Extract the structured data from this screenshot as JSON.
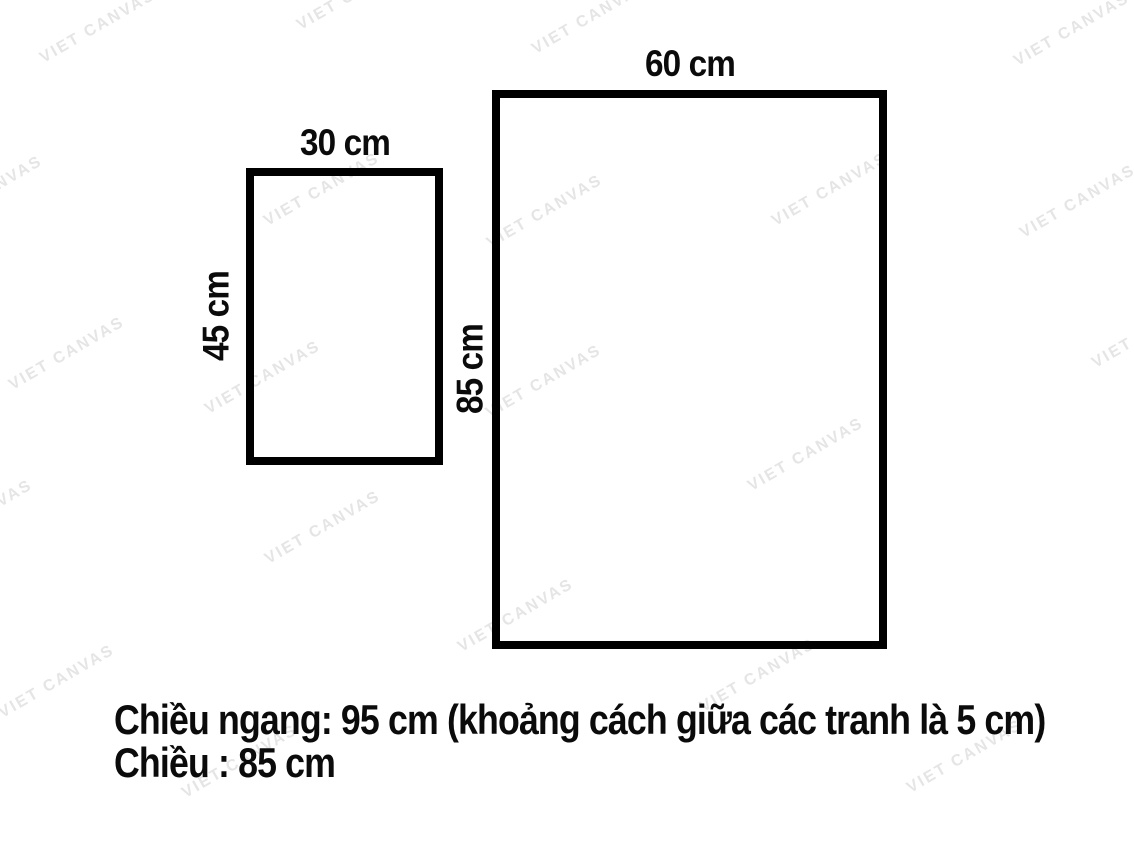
{
  "watermark": {
    "text": "VIET CANVAS",
    "color": "#e5e5e5",
    "angle_deg": -30
  },
  "diagram": {
    "stroke_color": "#000000",
    "stroke_px": 8,
    "frames": [
      {
        "name": "small-frame",
        "width_label": "30 cm",
        "height_label": "45 cm"
      },
      {
        "name": "large-frame",
        "width_label": "60 cm",
        "height_label": "85 cm"
      }
    ]
  },
  "caption": {
    "line1": "Chiều ngang: 95 cm (khoảng cách giữa các tranh là 5 cm)",
    "line2": "Chiều : 85 cm"
  }
}
